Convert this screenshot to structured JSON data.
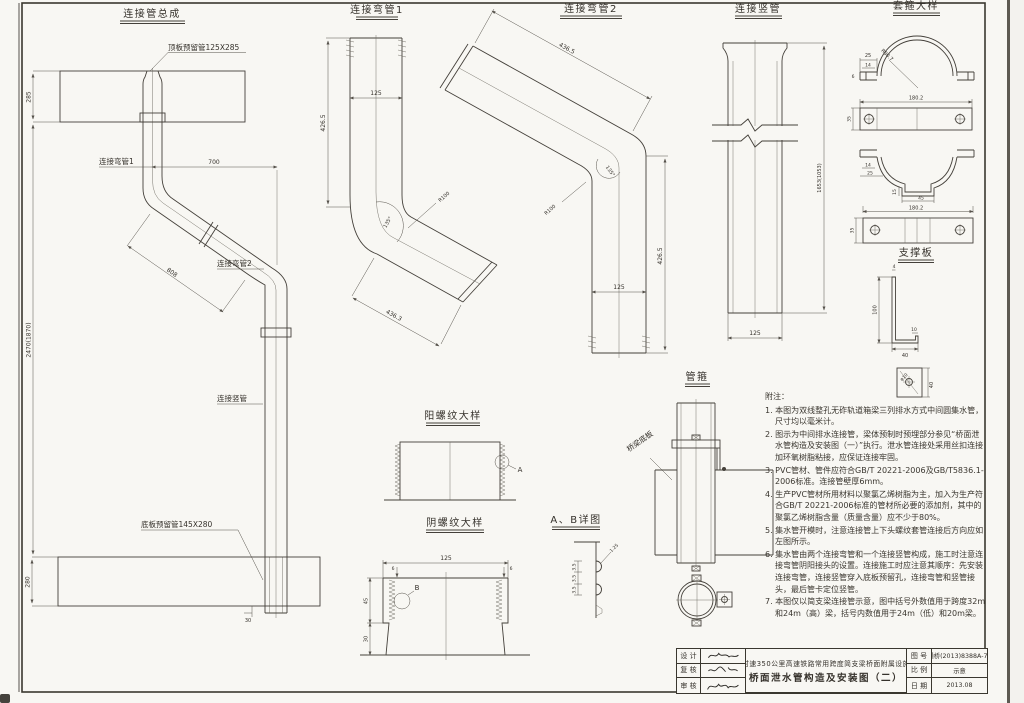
{
  "drawing": {
    "paper_color": "#f8f7f3",
    "ink_color": "#35312b"
  },
  "views": {
    "assembly": {
      "title": "连接管总成",
      "label_top_pipe": "顶板预留管125X285",
      "label_bend1": "连接弯管1",
      "label_bend2": "连接弯管2",
      "label_vertical": "连接竖管",
      "label_bottom_pipe": "底板预留管145X280",
      "dim_top_slab": "285",
      "dim_horizontal": "700",
      "dim_diagonal": "808",
      "dim_overall": "2470(1870)",
      "dim_bottom_slab": "280",
      "dim_bottom_offset": "30"
    },
    "bend1": {
      "title": "连接弯管1",
      "dim_height": "426.5",
      "dim_width": "125",
      "dim_radius": "R100",
      "dim_angle": "135°",
      "dim_diagonal": "436.3"
    },
    "bend2": {
      "title": "连接弯管2",
      "dim_diagonal": "436.5",
      "dim_radius": "R100",
      "dim_angle": "135°",
      "dim_height": "426.5",
      "dim_width": "125"
    },
    "vertical_pipe": {
      "title": "连接竖管",
      "dim_height": "1653(1053)",
      "dim_width": "125"
    },
    "hoop": {
      "title": "套箍大样",
      "dim_tab_width": "25",
      "dim_tab_inner": "14",
      "dim_radius": "R80.7",
      "dim_wall": "6",
      "dim_plate_length": "180.2",
      "dim_plate_height": "35",
      "dim_tab_inner_2": "14",
      "dim_tab_width_2": "25",
      "dim_notch_depth": "15",
      "dim_notch_width": "45",
      "dim_plate2_length": "180.2",
      "dim_plate2_height": "35"
    },
    "support_plate": {
      "title": "支撑板",
      "dim_height": "100",
      "dim_thickness": "4",
      "dim_lip": "10",
      "dim_leg": "40",
      "dim_square": "40",
      "label_hole": "φ10"
    },
    "male_thread": {
      "title": "阳螺纹大样",
      "detail_label": "A"
    },
    "female_thread": {
      "title": "阴螺纹大样",
      "detail_label": "B",
      "dim_width": "125",
      "dim_wall_left": "6",
      "dim_wall_right": "6",
      "dim_thread_zone": "45",
      "dim_leg": "30"
    },
    "thread_detail": {
      "title": "A、B详图",
      "dim_radius": "1.25",
      "dim_pitch_1": "3.5",
      "dim_pitch_2": "3.5",
      "dim_pitch_3": "3.5"
    },
    "pipe_clamp": {
      "title": "管箍",
      "label_slab": "桥梁底板"
    }
  },
  "notes": {
    "title": "附注：",
    "items": [
      "1. 本图为双线整孔无砟轨道箱梁三列排水方式中间圆集水管，尺寸均以毫米计。",
      "2. 图示为中间排水连接管，梁体预制时预埋部分参见“桥面泄水管构造及安装图（一）”执行。泄水管连接处采用丝扣连接加环氧树脂粘接，应保证连接牢固。",
      "3. PVC管材、管件应符合GB/T 20221-2006及GB/T5836.1-2006标准。连接管壁厚6mm。",
      "4. 生产PVC管材所用材料以聚氯乙烯树脂为主，加入为生产符合GB/T 20221-2006标准的管材所必要的添加剂，其中的聚氯乙烯树脂含量（质量含量）应不少于80%。",
      "5. 集水管开模时，注意连接管上下头螺纹套管连接后方向应如左图所示。",
      "6. 集水管由两个连接弯管和一个连接竖管构成，施工时注意连接弯管阴阳接头的设置。连接施工时应注意其顺序：先安装连接弯管，连接竖管穿入底板预留孔，连接弯管和竖管接头，最后管卡定位竖管。",
      "7. 本图仅以简支梁连接管示意，图中括号外数值用于跨度32m和24m（高）梁，括号内数值用于24m（低）和20m梁。"
    ]
  },
  "title_block": {
    "sign_rows": [
      {
        "label": "设 计"
      },
      {
        "label": "复 核"
      },
      {
        "label": "审 核"
      }
    ],
    "project_line": "时速350公里高速铁路常用跨度简支梁桥面附属设施",
    "drawing_title": "桥面泄水管构造及安装图（二）",
    "fields": [
      {
        "label": "图 号",
        "value": "通桥(2013)8388A-73"
      },
      {
        "label": "比 例",
        "value": "示意"
      },
      {
        "label": "日 期",
        "value": "2013.08"
      }
    ]
  }
}
